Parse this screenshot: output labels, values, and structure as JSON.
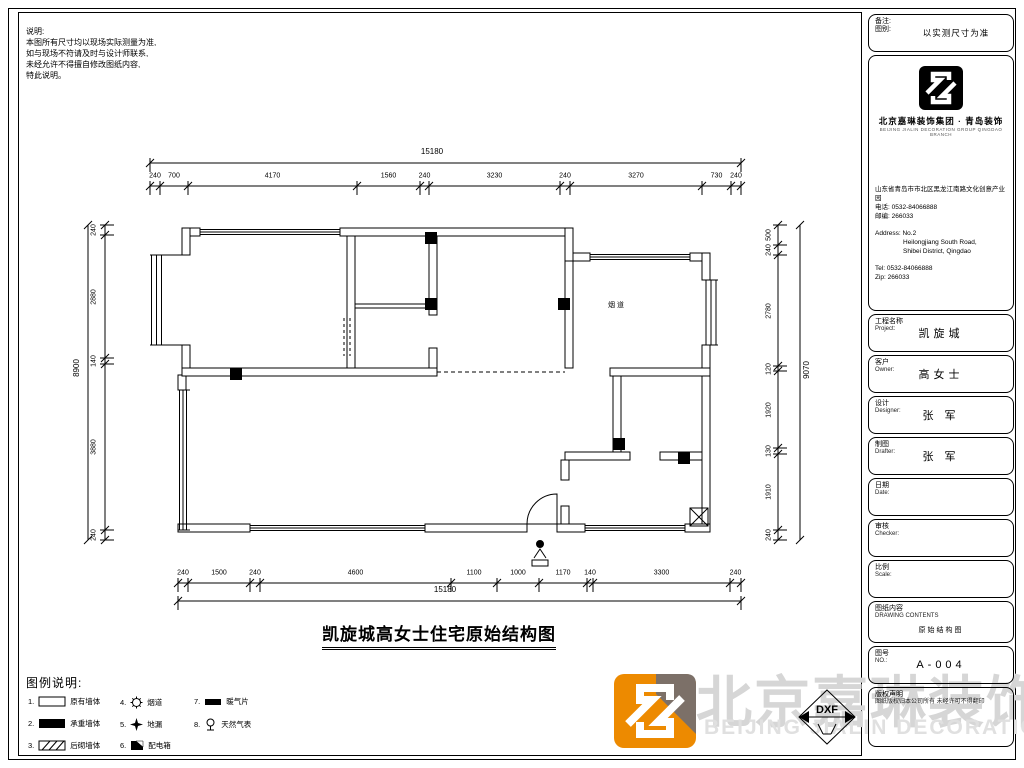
{
  "notes": {
    "title": "说明:",
    "lines": [
      "本图所有尺寸均以现场实际测量为准,",
      "如与现场不符请及时与设计师联系,",
      "未经允许不得擅自修改图纸内容,",
      "特此说明。"
    ]
  },
  "plan": {
    "title": "凯旋城高女士住宅原始结构图",
    "flue_label": "烟道"
  },
  "dims": {
    "top": {
      "overall": "15180",
      "chain": [
        "240",
        "700",
        "4170",
        "1560",
        "240",
        "3230",
        "240",
        "3270",
        "730",
        "240"
      ]
    },
    "bottom": {
      "overall": "15180",
      "chain": [
        "240",
        "1500",
        "240",
        "4600",
        "1100",
        "1000",
        "1170",
        "140",
        "3300",
        "240"
      ]
    },
    "left": {
      "overall": "8900",
      "chain": [
        "240",
        "2880",
        "140",
        "3880",
        "240"
      ]
    },
    "right": {
      "overall": "9070",
      "chain": [
        "500",
        "240",
        "2780",
        "120",
        "1920",
        "130",
        "1910",
        "240"
      ]
    }
  },
  "legend": {
    "title": "图例说明:",
    "items": [
      {
        "num": "1.",
        "label": "原有墙体",
        "icon": "wall-outline"
      },
      {
        "num": "2.",
        "label": "承重墙体",
        "icon": "wall-filled"
      },
      {
        "num": "3.",
        "label": "后砌墙体",
        "icon": "wall-hatched"
      },
      {
        "num": "4.",
        "label": "烟道",
        "icon": "gear"
      },
      {
        "num": "5.",
        "label": "地漏",
        "icon": "drain-star"
      },
      {
        "num": "6.",
        "label": "配电箱",
        "icon": "electric-panel"
      },
      {
        "num": "7.",
        "label": "暖气片",
        "icon": "radiator"
      },
      {
        "num": "8.",
        "label": "天然气表",
        "icon": "gas-meter"
      }
    ]
  },
  "titleblock": {
    "remark_label": "备注:",
    "sheet_label": "图别:",
    "remark_value": "以实测尺寸为准",
    "company_cn": "北京嘉琳装饰集团 · 青岛装饰",
    "company_sub": "BEIJING JIALIN DECORATION GROUP QINGDAO BRANCH",
    "address_cn": "山东省青岛市市北区黑龙江南路文化创意产业园",
    "phone_cn": "电话: 0532-84066888",
    "zip_cn": "邮编: 266033",
    "address_en1": "Address: No.2",
    "address_en2": "Heilongjiang South Road,",
    "address_en3": "Shibei District, Qingdao",
    "tel_en": "Tel: 0532-84066888",
    "zip_en": "Zip: 266033",
    "rows": [
      {
        "label_cn": "工程名称",
        "label_en": "Project:",
        "value": "凯旋城"
      },
      {
        "label_cn": "客户",
        "label_en": "Owner:",
        "value": "高女士"
      },
      {
        "label_cn": "设计",
        "label_en": "Designer:",
        "value": "张 军"
      },
      {
        "label_cn": "制图",
        "label_en": "Drafter:",
        "value": "张 军"
      },
      {
        "label_cn": "日期",
        "label_en": "Date:",
        "value": ""
      },
      {
        "label_cn": "审核",
        "label_en": "Checker:",
        "value": ""
      },
      {
        "label_cn": "比例",
        "label_en": "Scale:",
        "value": ""
      },
      {
        "label_cn": "图纸内容",
        "label_en": "DRAWING CONTENTS",
        "value": "原始结构图"
      },
      {
        "label_cn": "图号",
        "label_en": "NO.:",
        "value": "A-004"
      },
      {
        "label_cn": "版权声明",
        "label_en": "图纸版权归本公司所有 未经许可不得翻印",
        "value": ""
      }
    ]
  },
  "watermark": {
    "cn": "北京嘉琳装饰",
    "en": "BEIJING JIALIN DECORATION",
    "stamp": "DXF",
    "orange": "#ED8A00",
    "gray": "#7C7068"
  }
}
